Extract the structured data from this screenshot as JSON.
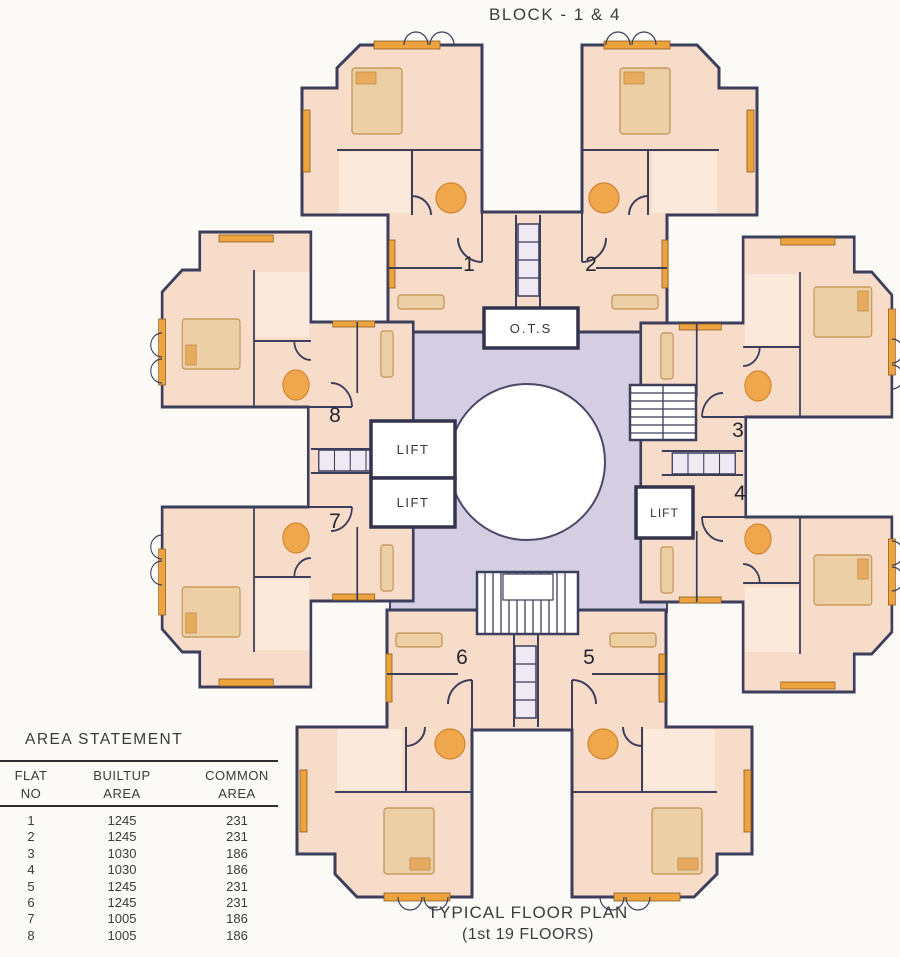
{
  "title": "BLOCK - 1 & 4",
  "plan": {
    "ots": "O.T.S",
    "lifts": [
      "LIFT",
      "LIFT",
      "LIFT"
    ],
    "flats": [
      {
        "no": "1"
      },
      {
        "no": "2"
      },
      {
        "no": "3"
      },
      {
        "no": "4"
      },
      {
        "no": "5"
      },
      {
        "no": "6"
      },
      {
        "no": "7"
      },
      {
        "no": "8"
      }
    ]
  },
  "footer": {
    "line1": "TYPICAL FLOOR PLAN",
    "line2": "(1st 19 FLOORS)"
  },
  "area_statement": {
    "title": "AREA STATEMENT",
    "col_headers": {
      "c1a": "FLAT",
      "c1b": "NO",
      "c2a": "BUILTUP",
      "c2b": "AREA",
      "c3a": "COMMON",
      "c3b": "AREA"
    },
    "rows": [
      {
        "flat": "1",
        "builtup": "1245",
        "common": "231"
      },
      {
        "flat": "2",
        "builtup": "1245",
        "common": "231"
      },
      {
        "flat": "3",
        "builtup": "1030",
        "common": "186"
      },
      {
        "flat": "4",
        "builtup": "1030",
        "common": "186"
      },
      {
        "flat": "5",
        "builtup": "1245",
        "common": "231"
      },
      {
        "flat": "6",
        "builtup": "1245",
        "common": "231"
      },
      {
        "flat": "7",
        "builtup": "1005",
        "common": "186"
      },
      {
        "flat": "8",
        "builtup": "1005",
        "common": "186"
      }
    ]
  },
  "colors": {
    "flat_fill": "#f8dcca",
    "common_area": "#d5cee2",
    "accent_orange": "#eda43e",
    "wall": "#3d3d5c"
  }
}
